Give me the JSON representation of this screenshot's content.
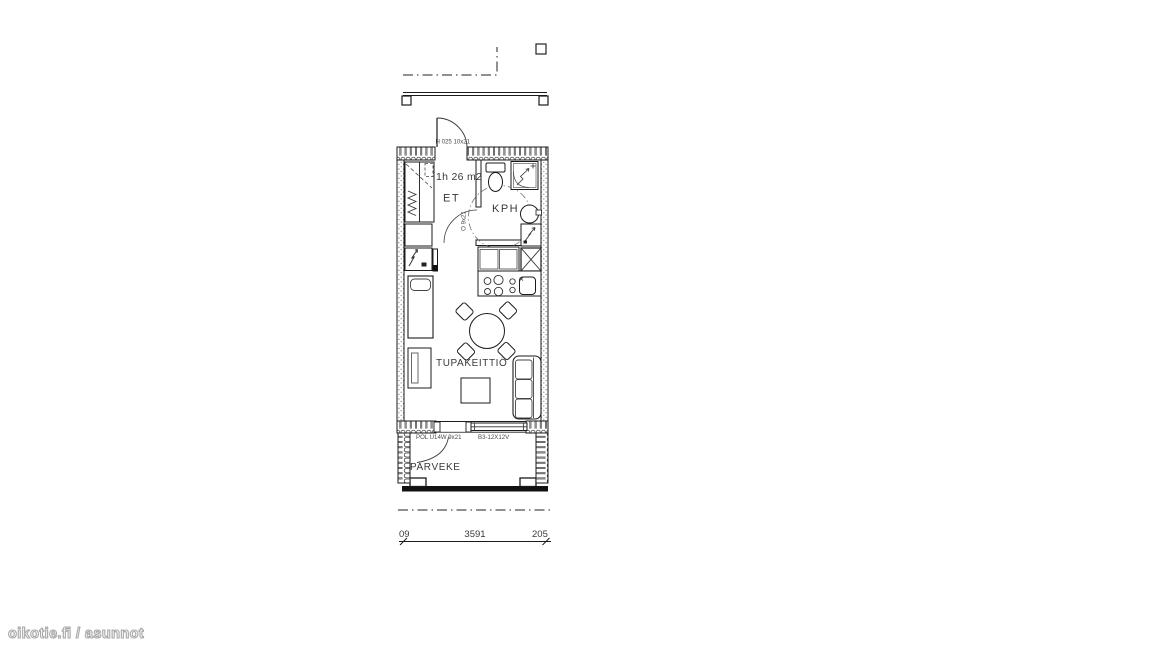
{
  "floorplan": {
    "apartment_label": "1h 26 m2",
    "rooms": {
      "entrance": "ET",
      "bathroom": "KPH",
      "kitchen_living": "TUPAKEITTIÖ",
      "balcony": "PARVEKE"
    },
    "door_codes": {
      "entrance_door": "H 025 10x21",
      "bathroom_door": "O 9x21",
      "balcony_door": "POL U14W 9x21",
      "window": "B3-12X12V"
    },
    "dimensions": {
      "left": "09",
      "middle": "3591",
      "right": "205"
    }
  },
  "watermark": "oikotie.fi / asunnot",
  "colors": {
    "line": "#1b1b1b",
    "text": "#3a3a3a",
    "watermark_outline": "#a9a9a9"
  }
}
